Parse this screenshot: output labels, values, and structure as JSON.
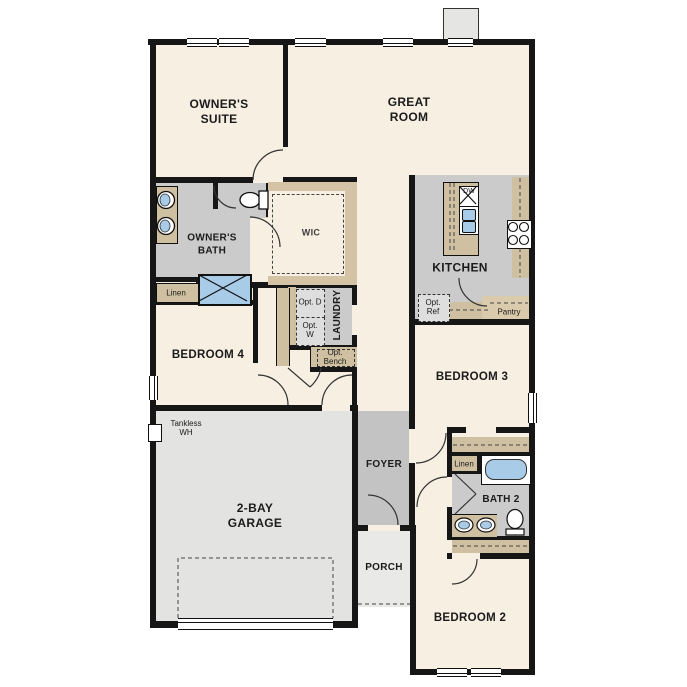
{
  "plan_title": "Single-story floor plan",
  "rooms": {
    "owners_suite": {
      "label": "OWNER'S SUITE"
    },
    "great_room": {
      "label": "GREAT ROOM"
    },
    "owners_bath": {
      "label": "OWNER'S BATH"
    },
    "wic": {
      "label": "WIC"
    },
    "bedroom4": {
      "label": "BEDROOM 4"
    },
    "laundry": {
      "label": "LAUNDRY"
    },
    "kitchen": {
      "label": "KITCHEN"
    },
    "bedroom3": {
      "label": "BEDROOM 3"
    },
    "bath2": {
      "label": "BATH 2"
    },
    "bedroom2": {
      "label": "BEDROOM 2"
    },
    "garage": {
      "label": "2-BAY GARAGE"
    },
    "foyer": {
      "label": "FOYER"
    },
    "porch": {
      "label": "PORCH"
    }
  },
  "features": {
    "linen_owner": "Linen",
    "linen_bath2": "Linen",
    "pantry": "Pantry",
    "opt_ref": "Opt. Ref",
    "opt_dryer": "Opt. D",
    "opt_washer": "Opt. W",
    "opt_bench": "Opt. Bench",
    "dishwasher": "DW",
    "tankless_wh": "Tankless WH"
  },
  "colors": {
    "floor_cream": "#f6efe2",
    "wet_room_gray": "#cbcbcb",
    "garage_gray": "#e3e3e1",
    "foyer_gray": "#c3c3c3",
    "porch_gray": "#e9e9e7",
    "cabinet_tan": "#cfc0a1",
    "fixture_blue": "#a8cbe8",
    "wall_black": "#161616"
  }
}
